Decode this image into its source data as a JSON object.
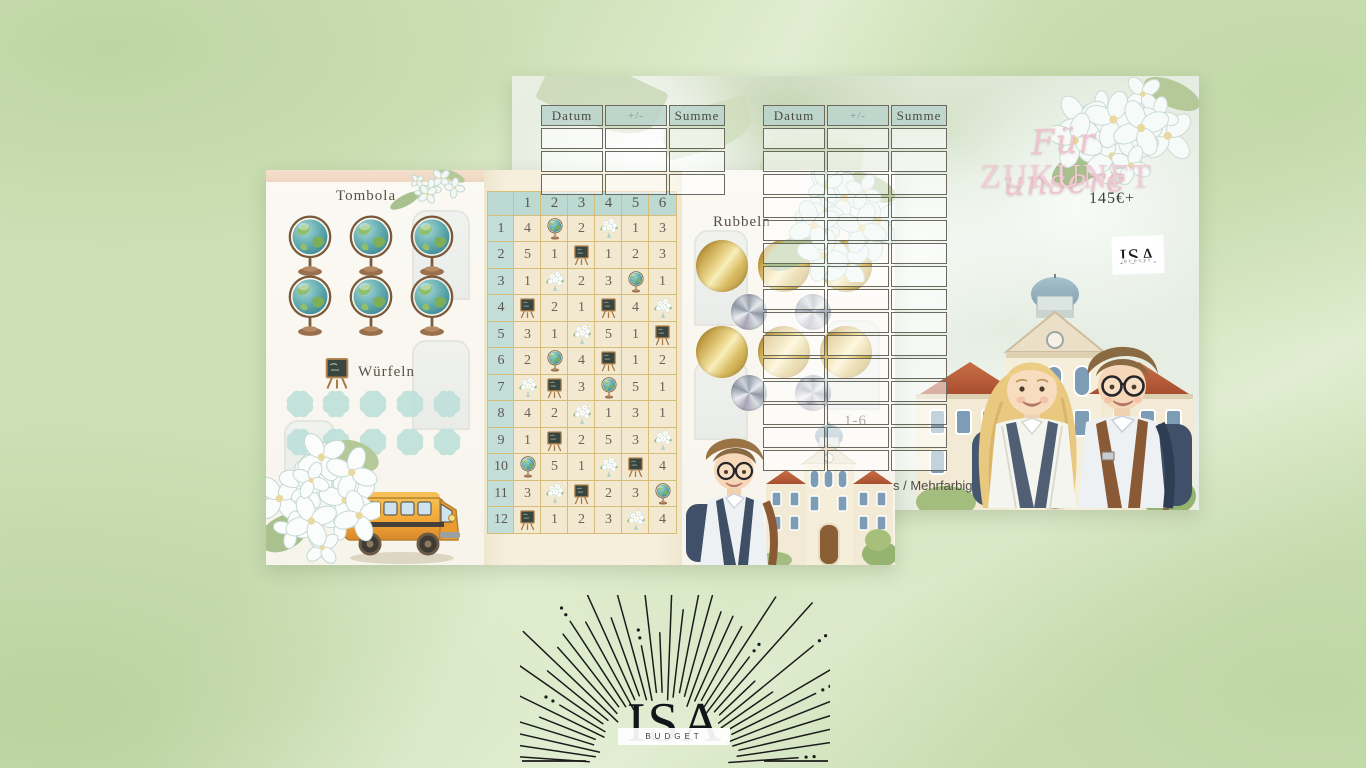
{
  "front_card": {
    "tombola": {
      "title": "Tombola",
      "globe_count": 6
    },
    "wuerfeln": {
      "title": "Würfeln",
      "slot_count": 10,
      "slot_rows": 2
    },
    "grid": {
      "columns": [
        "1",
        "2",
        "3",
        "4",
        "5",
        "6"
      ],
      "rows": [
        {
          "label": "1",
          "cells": [
            "4",
            "globe",
            "2",
            "flowers",
            "1",
            "3"
          ]
        },
        {
          "label": "2",
          "cells": [
            "5",
            "1",
            "board",
            "1",
            "2",
            "3"
          ]
        },
        {
          "label": "3",
          "cells": [
            "1",
            "flowers",
            "2",
            "3",
            "globe",
            "1"
          ]
        },
        {
          "label": "4",
          "cells": [
            "board",
            "2",
            "1",
            "board",
            "4",
            "flowers"
          ]
        },
        {
          "label": "5",
          "cells": [
            "3",
            "1",
            "flowers",
            "5",
            "1",
            "board"
          ]
        },
        {
          "label": "6",
          "cells": [
            "2",
            "globe",
            "4",
            "board",
            "1",
            "2"
          ]
        },
        {
          "label": "7",
          "cells": [
            "flowers",
            "board",
            "3",
            "globe",
            "5",
            "1"
          ]
        },
        {
          "label": "8",
          "cells": [
            "4",
            "2",
            "flowers",
            "1",
            "3",
            "1"
          ]
        },
        {
          "label": "9",
          "cells": [
            "1",
            "board",
            "2",
            "5",
            "3",
            "flowers"
          ]
        },
        {
          "label": "10",
          "cells": [
            "globe",
            "5",
            "1",
            "flowers",
            "board",
            "4"
          ]
        },
        {
          "label": "11",
          "cells": [
            "3",
            "flowers",
            "board",
            "2",
            "3",
            "globe"
          ]
        },
        {
          "label": "12",
          "cells": [
            "board",
            "1",
            "2",
            "3",
            "flowers",
            "4"
          ]
        }
      ]
    },
    "rubbeln": {
      "title": "Rubbeln",
      "gold_count": 6,
      "silver_count": 4,
      "range_label": "1-6"
    }
  },
  "back_card": {
    "tracker_headers": [
      "Datum",
      "+/-",
      "Summe"
    ],
    "tracker_left_rows": 3,
    "tracker_right_rows": 15,
    "title_line1": "Für unsere",
    "title_line2": "ZUKUNFT",
    "price": "145€+",
    "brand": "ISA",
    "brand_sub": "BUDGET",
    "variant_label": "s / Mehrfarbig"
  },
  "logo": {
    "brand": "ISA",
    "sub": "BUDGET"
  },
  "colors": {
    "background": "#cde0b6",
    "mint_header": "#bcdad2",
    "cream_cell": "#f2e9d0",
    "gold_foil": "#e4c979",
    "silver_foil": "#c3c9d1",
    "title_pink": "#f0cdd5"
  }
}
